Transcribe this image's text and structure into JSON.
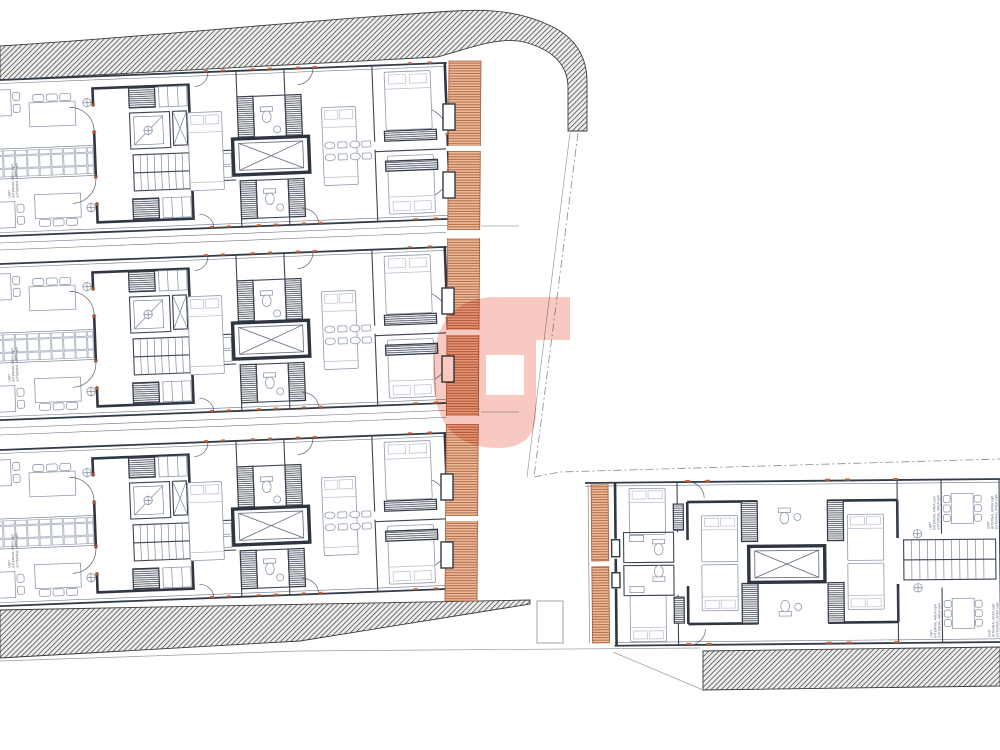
{
  "drawing": {
    "kind": "architectural-floor-plan",
    "left_building": {
      "unit_blocks": 3,
      "units_per_block": 2
    },
    "right_building": {
      "unit_blocks": 1,
      "units_per_block": 2
    },
    "labels": {
      "unit": "UNIT",
      "internal": "INTERNAL AREA sqm",
      "external": "EXTERNAL AREA sqm"
    },
    "watermark": {
      "glyph": "G",
      "color": "#f8c2b7"
    },
    "colors": {
      "background": "#ffffff",
      "wall_dark": "#2d3641",
      "line_medium": "#6a7587",
      "furniture_light": "#8e98ab",
      "accent_orange": "#cf6330",
      "deck_fill": "#eebd9d",
      "deck_line": "#a65a36",
      "site_hatch": "#3a3a3a",
      "logo_pink": "#f8c2b7"
    }
  }
}
